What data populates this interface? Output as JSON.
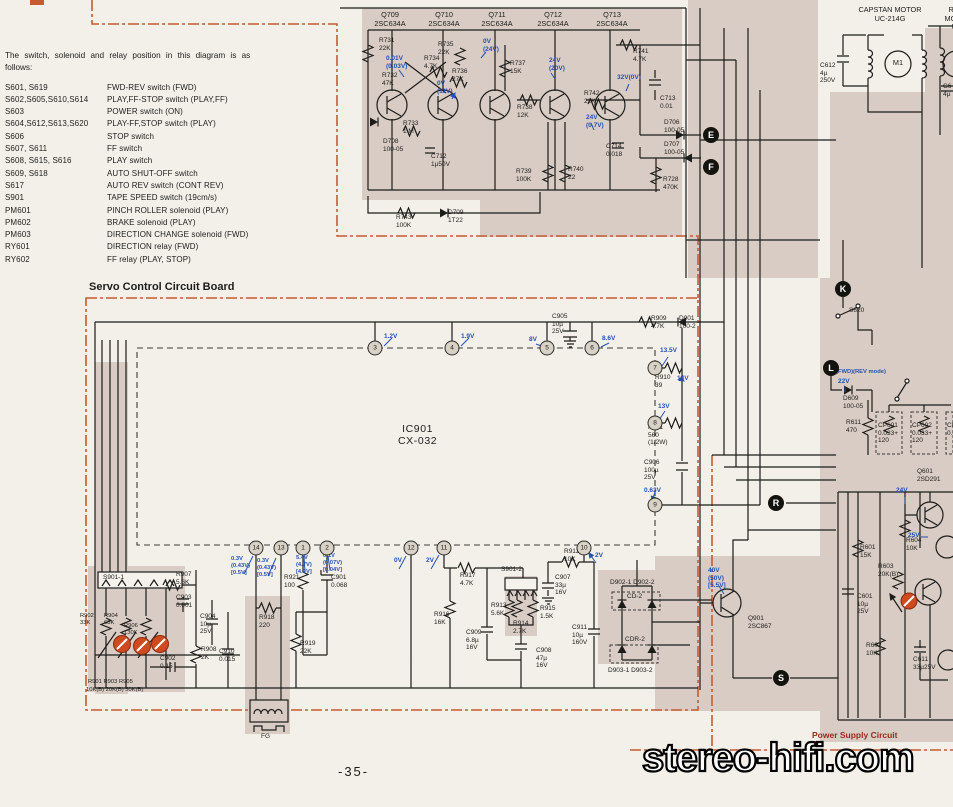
{
  "page": {
    "number": "-35-",
    "watermark": "stereo-hifi.com"
  },
  "boards": {
    "servo_title": "Servo Control Circuit Board",
    "power_title": "Power Supply Circuit"
  },
  "legend": {
    "intro": "The  switch,  solenoid  and  relay  position  in  this  diagram  is  as\nfollows:",
    "rows": [
      {
        "id": "S601, S619",
        "desc": "FWD-REV switch (FWD)"
      },
      {
        "id": "S602,S605,S610,S614",
        "desc": "PLAY,FF-STOP switch (PLAY,FF)"
      },
      {
        "id": "S603",
        "desc": "POWER switch (ON)"
      },
      {
        "id": "S604,S612,S613,S620",
        "desc": "PLAY-FF,STOP switch (PLAY)"
      },
      {
        "id": "S606",
        "desc": "STOP switch"
      },
      {
        "id": "S607, S611",
        "desc": "FF switch"
      },
      {
        "id": "S608, S615, S616",
        "desc": "PLAY switch"
      },
      {
        "id": "S609, S618",
        "desc": "AUTO SHUT-OFF switch"
      },
      {
        "id": "S617",
        "desc": "AUTO REV switch (CONT REV)"
      },
      {
        "id": "S901",
        "desc": "TAPE SPEED switch (19cm/s)"
      },
      {
        "id": "PM601",
        "desc": "PINCH ROLLER solenoid (PLAY)"
      },
      {
        "id": "PM602",
        "desc": "BRAKE solenoid (PLAY)"
      },
      {
        "id": "PM603",
        "desc": "DIRECTION CHANGE solenoid (FWD)"
      },
      {
        "id": "RY601",
        "desc": "DIRECTION relay (FWD)"
      },
      {
        "id": "RY602",
        "desc": "FF relay (PLAY, STOP)"
      }
    ]
  },
  "ic": {
    "name": "IC901\nCX-032"
  },
  "pins": [
    {
      "n": "3",
      "x": 375,
      "y": 348
    },
    {
      "n": "4",
      "x": 452,
      "y": 348
    },
    {
      "n": "5",
      "x": 547,
      "y": 348
    },
    {
      "n": "6",
      "x": 592,
      "y": 348
    },
    {
      "n": "7",
      "x": 655,
      "y": 368
    },
    {
      "n": "8",
      "x": 655,
      "y": 423
    },
    {
      "n": "9",
      "x": 655,
      "y": 505
    },
    {
      "n": "14",
      "x": 256,
      "y": 548
    },
    {
      "n": "13",
      "x": 281,
      "y": 548
    },
    {
      "n": "1",
      "x": 303,
      "y": 548
    },
    {
      "n": "2",
      "x": 327,
      "y": 548
    },
    {
      "n": "12",
      "x": 411,
      "y": 548
    },
    {
      "n": "11",
      "x": 444,
      "y": 548
    },
    {
      "n": "10",
      "x": 584,
      "y": 548
    }
  ],
  "terminals": [
    {
      "l": "E",
      "x": 711,
      "y": 135
    },
    {
      "l": "F",
      "x": 711,
      "y": 167
    },
    {
      "l": "K",
      "x": 843,
      "y": 289
    },
    {
      "l": "L",
      "x": 831,
      "y": 368
    },
    {
      "l": "R",
      "x": 776,
      "y": 503
    },
    {
      "l": "S",
      "x": 781,
      "y": 678
    }
  ],
  "colors": {
    "accent_orange": "#c65b30",
    "voltage_blue": "#2450b4",
    "board_beige": "#d9ccc4",
    "adjust_red": "#cf4a1e"
  },
  "labels": [
    {
      "t": "Q709\n2SC634A",
      "x": 390,
      "y": 11,
      "a": "c",
      "cls": "md"
    },
    {
      "t": "Q710\n2SC634A",
      "x": 444,
      "y": 11,
      "a": "c",
      "cls": "md"
    },
    {
      "t": "Q711\n2SC634A",
      "x": 497,
      "y": 11,
      "a": "c",
      "cls": "md"
    },
    {
      "t": "Q712\n2SC634A",
      "x": 553,
      "y": 11,
      "a": "c",
      "cls": "md"
    },
    {
      "t": "Q713\n2SC634A",
      "x": 612,
      "y": 11,
      "a": "c",
      "cls": "md"
    },
    {
      "t": "R731\n22K",
      "x": 379,
      "y": 37
    },
    {
      "t": "R735\n22K",
      "x": 438,
      "y": 41
    },
    {
      "t": "R734\n4.7K",
      "x": 424,
      "y": 55
    },
    {
      "t": "R732\n47K",
      "x": 382,
      "y": 72
    },
    {
      "t": "R736\n27K",
      "x": 452,
      "y": 68
    },
    {
      "t": "R737\n15K",
      "x": 510,
      "y": 60
    },
    {
      "t": "R738\n12K",
      "x": 517,
      "y": 104
    },
    {
      "t": "R741\n4.7K",
      "x": 633,
      "y": 48
    },
    {
      "t": "R742\n22K",
      "x": 584,
      "y": 90
    },
    {
      "t": "R733\n1 M",
      "x": 403,
      "y": 120
    },
    {
      "t": "D708\n100-05",
      "x": 383,
      "y": 138
    },
    {
      "t": "C712\n1µ50V",
      "x": 431,
      "y": 153
    },
    {
      "t": "R739\n100K",
      "x": 516,
      "y": 168
    },
    {
      "t": "R740\n22",
      "x": 568,
      "y": 166
    },
    {
      "t": "R743\n100K",
      "x": 396,
      "y": 214
    },
    {
      "t": "D709\n1T22",
      "x": 448,
      "y": 209
    },
    {
      "t": "C714\n0.018",
      "x": 606,
      "y": 143
    },
    {
      "t": "C713\n0.01",
      "x": 660,
      "y": 95
    },
    {
      "t": "D706\n100-05",
      "x": 664,
      "y": 119
    },
    {
      "t": "D707\n100-05",
      "x": 664,
      "y": 141
    },
    {
      "t": "R728\n470K",
      "x": 663,
      "y": 176
    },
    {
      "t": "0.01V\n(0.03V)",
      "x": 386,
      "y": 55,
      "c": "b"
    },
    {
      "t": "0V\n(11V)",
      "x": 437,
      "y": 80,
      "c": "b"
    },
    {
      "t": "0V\n(24V)",
      "x": 483,
      "y": 38,
      "c": "b"
    },
    {
      "t": "24V\n(20V)",
      "x": 549,
      "y": 57,
      "c": "b"
    },
    {
      "t": "32V(0V)",
      "x": 617,
      "y": 74,
      "c": "b"
    },
    {
      "t": "24V\n(0.7V)",
      "x": 586,
      "y": 114,
      "c": "b"
    },
    {
      "t": "CAPSTAN MOTOR\nUC-214G",
      "x": 890,
      "y": 6,
      "a": "c",
      "cls": "md"
    },
    {
      "t": "REEL MOTOR\nUC-",
      "x": 958,
      "y": 6,
      "a": "c",
      "cls": "md"
    },
    {
      "t": "C612\n4µ\n250V",
      "x": 820,
      "y": 62
    },
    {
      "t": "M1",
      "x": 898,
      "y": 59,
      "a": "c",
      "cls": "md"
    },
    {
      "t": "C6\n4µ",
      "x": 943,
      "y": 83
    },
    {
      "t": "C905\n10µ\n25V",
      "x": 552,
      "y": 313
    },
    {
      "t": "R909\n4.7K",
      "x": 651,
      "y": 315
    },
    {
      "t": "D901\n100-2",
      "x": 679,
      "y": 315
    },
    {
      "t": "R910\n39",
      "x": 655,
      "y": 374
    },
    {
      "t": "R911\n560\n(1/2W)",
      "x": 648,
      "y": 424
    },
    {
      "t": "C906\n100µ\n25V",
      "x": 644,
      "y": 459
    },
    {
      "t": "1.2V",
      "x": 384,
      "y": 333,
      "c": "b"
    },
    {
      "t": "1.9V",
      "x": 461,
      "y": 333,
      "c": "b"
    },
    {
      "t": "8V",
      "x": 529,
      "y": 336,
      "c": "b"
    },
    {
      "t": "8.6V",
      "x": 602,
      "y": 335,
      "c": "b"
    },
    {
      "t": "13.5V",
      "x": 660,
      "y": 347,
      "c": "b"
    },
    {
      "t": "14V",
      "x": 677,
      "y": 375,
      "c": "b"
    },
    {
      "t": "13V",
      "x": 658,
      "y": 403,
      "c": "b"
    },
    {
      "t": "0.63V",
      "x": 644,
      "y": 487,
      "c": "b"
    },
    {
      "t": "0.3V\n(0.43V)\n[0.5V]",
      "x": 231,
      "y": 556,
      "c": "b",
      "cls": "sm"
    },
    {
      "t": "0.3V\n(0.43V)\n[0.5V]",
      "x": 257,
      "y": 558,
      "c": "b",
      "cls": "sm"
    },
    {
      "t": "5.4V\n(4.7V)\n[4.2V]",
      "x": 296,
      "y": 555,
      "c": "b",
      "cls": "sm"
    },
    {
      "t": "0.1V\n(0.07V)\n[0.04V]",
      "x": 323,
      "y": 553,
      "c": "b",
      "cls": "sm"
    },
    {
      "t": "0V",
      "x": 394,
      "y": 557,
      "c": "b"
    },
    {
      "t": "2V",
      "x": 426,
      "y": 557,
      "c": "b"
    },
    {
      "t": "2V",
      "x": 595,
      "y": 552,
      "c": "b"
    },
    {
      "t": "R921\n100",
      "x": 284,
      "y": 574
    },
    {
      "t": "C901\n0.068",
      "x": 331,
      "y": 574
    },
    {
      "t": "R918\n220",
      "x": 259,
      "y": 614
    },
    {
      "t": "R919\n22K",
      "x": 300,
      "y": 640
    },
    {
      "t": "R907\n5.6K",
      "x": 176,
      "y": 571
    },
    {
      "t": "C903\n0.001",
      "x": 176,
      "y": 594
    },
    {
      "t": "C904\n10µ\n25V",
      "x": 200,
      "y": 613
    },
    {
      "t": "R908\n2K",
      "x": 201,
      "y": 646
    },
    {
      "t": "C902\n0.15",
      "x": 160,
      "y": 655
    },
    {
      "t": "C910\n0.015",
      "x": 219,
      "y": 648
    },
    {
      "t": "S901-1",
      "x": 103,
      "y": 574
    },
    {
      "t": "R902\n33K",
      "x": 80,
      "y": 613,
      "cls": "sm"
    },
    {
      "t": "R904\n68K",
      "x": 104,
      "y": 613,
      "cls": "sm"
    },
    {
      "t": "R906\n130K",
      "x": 124,
      "y": 623,
      "cls": "sm"
    },
    {
      "t": "R901  R903  R905",
      "x": 88,
      "y": 679,
      "cls": "sm"
    },
    {
      "t": "10K(B) 20K(B) 50K(B)",
      "x": 86,
      "y": 687,
      "cls": "sm"
    },
    {
      "t": "FG",
      "x": 261,
      "y": 733
    },
    {
      "t": "R917\n4.7K",
      "x": 460,
      "y": 572
    },
    {
      "t": "R916\n16K",
      "x": 434,
      "y": 611
    },
    {
      "t": "C909\n6.8µ\n16V",
      "x": 466,
      "y": 629
    },
    {
      "t": "S901-2",
      "x": 501,
      "y": 566
    },
    {
      "t": "R913\n5.6K",
      "x": 491,
      "y": 602
    },
    {
      "t": "R914\n2.7K",
      "x": 513,
      "y": 620
    },
    {
      "t": "R915\n1.5K",
      "x": 540,
      "y": 605
    },
    {
      "t": "C908\n47µ\n16V",
      "x": 536,
      "y": 647
    },
    {
      "t": "R912\n10K",
      "x": 564,
      "y": 548
    },
    {
      "t": "C907\n33µ\n16V",
      "x": 555,
      "y": 574
    },
    {
      "t": "C911\n10µ\n160V",
      "x": 572,
      "y": 624
    },
    {
      "t": "D902-1  D902-2",
      "x": 610,
      "y": 579
    },
    {
      "t": "CD-2",
      "x": 627,
      "y": 593
    },
    {
      "t": "CDR-2",
      "x": 625,
      "y": 636
    },
    {
      "t": "D903-1  D903-2",
      "x": 608,
      "y": 667
    },
    {
      "t": "40V\n(50V)\n[5.5V]",
      "x": 708,
      "y": 567,
      "c": "b"
    },
    {
      "t": "Q901\n2SC867",
      "x": 748,
      "y": 615
    },
    {
      "t": "S620",
      "x": 849,
      "y": 307
    },
    {
      "t": "(FWD)(REV mode)",
      "x": 836,
      "y": 369,
      "c": "b",
      "cls": "sm"
    },
    {
      "t": "22V",
      "x": 838,
      "y": 378,
      "c": "b"
    },
    {
      "t": "D609\n100-05",
      "x": 843,
      "y": 395
    },
    {
      "t": "R611\n470",
      "x": 846,
      "y": 419
    },
    {
      "t": "CP601\n0.033+\n120",
      "x": 878,
      "y": 422
    },
    {
      "t": "CP602\n0.033+\n120",
      "x": 912,
      "y": 422
    },
    {
      "t": "CP6\n0.0",
      "x": 947,
      "y": 422
    },
    {
      "t": "Q601\n2SD291",
      "x": 917,
      "y": 468
    },
    {
      "t": "24V",
      "x": 896,
      "y": 487,
      "c": "b"
    },
    {
      "t": "25V",
      "x": 908,
      "y": 532,
      "c": "b"
    },
    {
      "t": "R601\n15K",
      "x": 860,
      "y": 544
    },
    {
      "t": "R604\n10K",
      "x": 906,
      "y": 537
    },
    {
      "t": "R603\n20K(B)",
      "x": 878,
      "y": 563
    },
    {
      "t": "C601\n10µ\n25V",
      "x": 857,
      "y": 593
    },
    {
      "t": "R602\n10K",
      "x": 866,
      "y": 642
    },
    {
      "t": "C611\n33µ25V",
      "x": 913,
      "y": 656
    }
  ]
}
